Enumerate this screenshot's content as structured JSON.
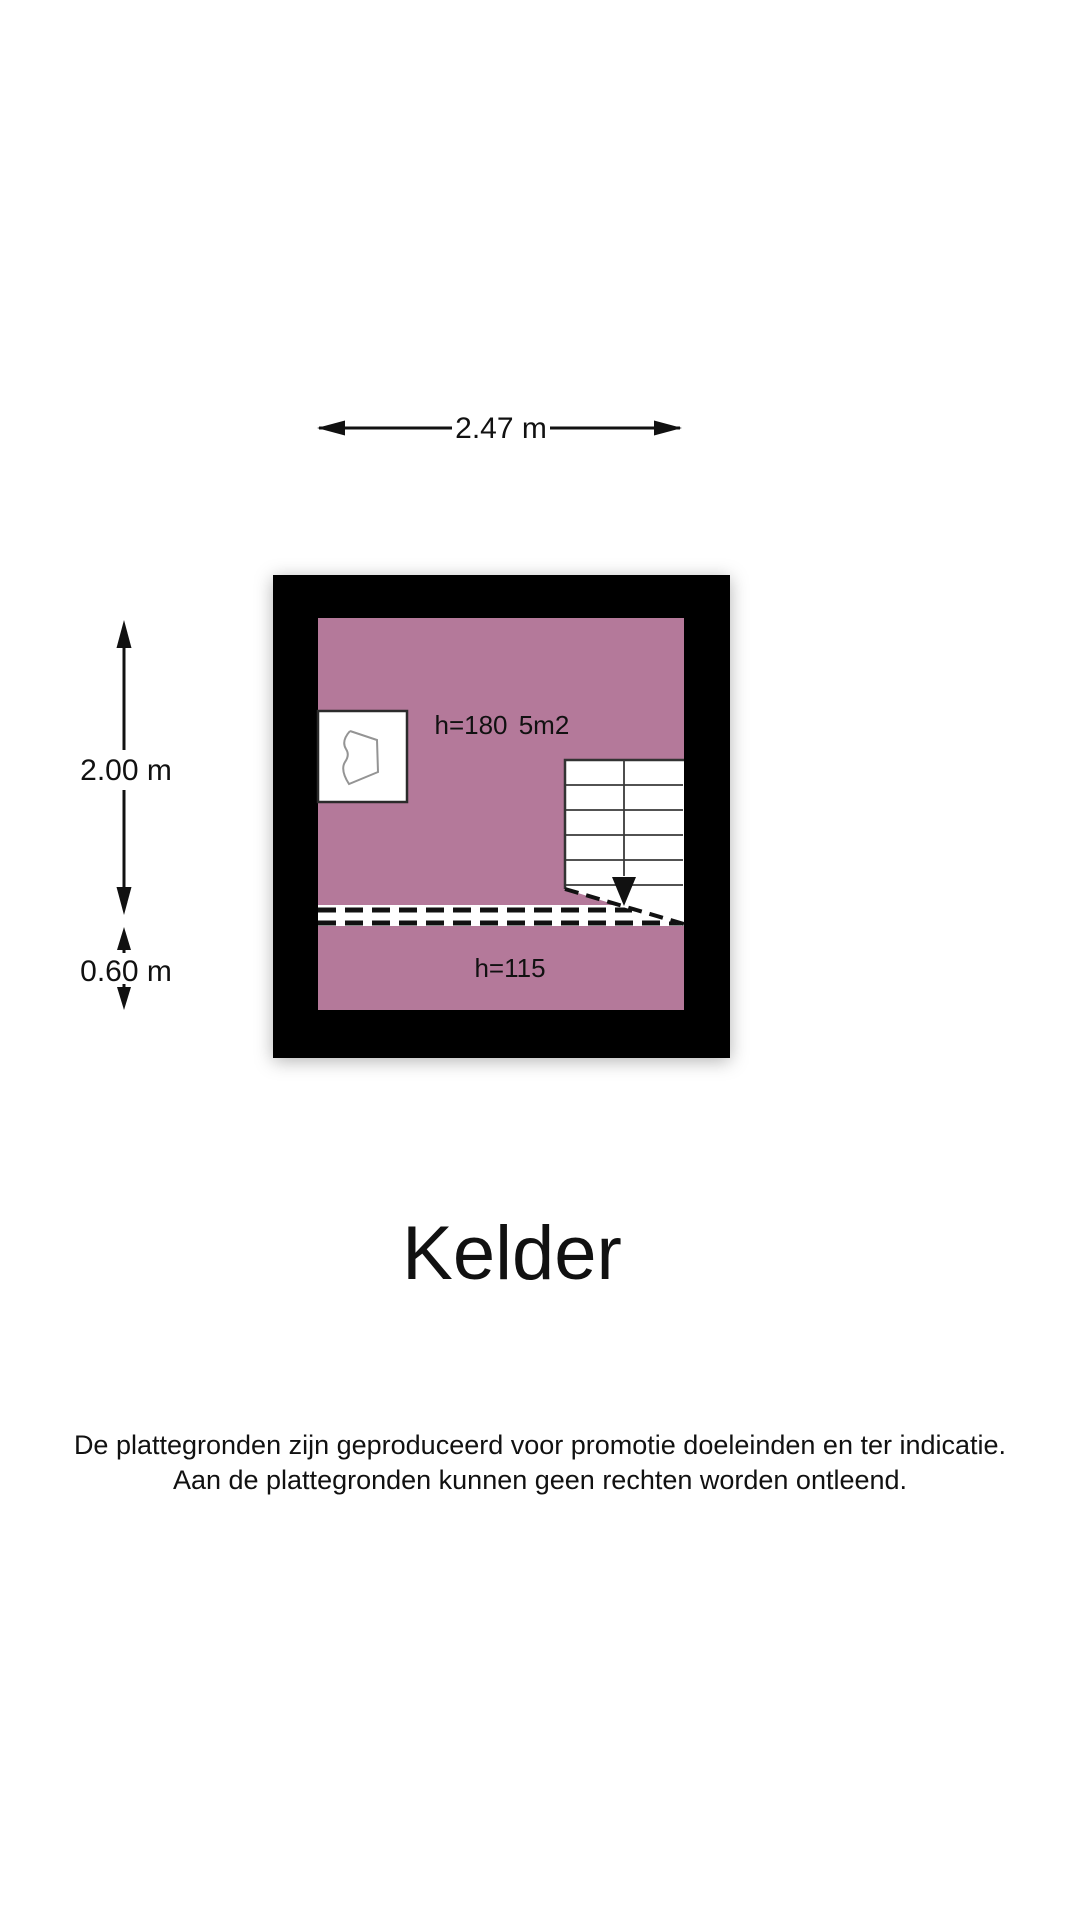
{
  "floorplan": {
    "dimensions": {
      "width_label": "2.47 m",
      "main_height_label": "2.00 m",
      "lower_height_label": "0.60 m"
    },
    "room": {
      "ceiling_height_label": "h=180",
      "area_label": "5m2",
      "lower_ceiling_height_label": "h=115"
    },
    "colors": {
      "room_fill": "#b4799a",
      "wall": "#000000",
      "line": "#111111"
    }
  },
  "title": "Kelder",
  "disclaimer": {
    "line1": "De plattegronden zijn geproduceerd voor promotie doeleinden en ter indicatie.",
    "line2": "Aan de plattegronden kunnen geen rechten worden ontleend."
  }
}
